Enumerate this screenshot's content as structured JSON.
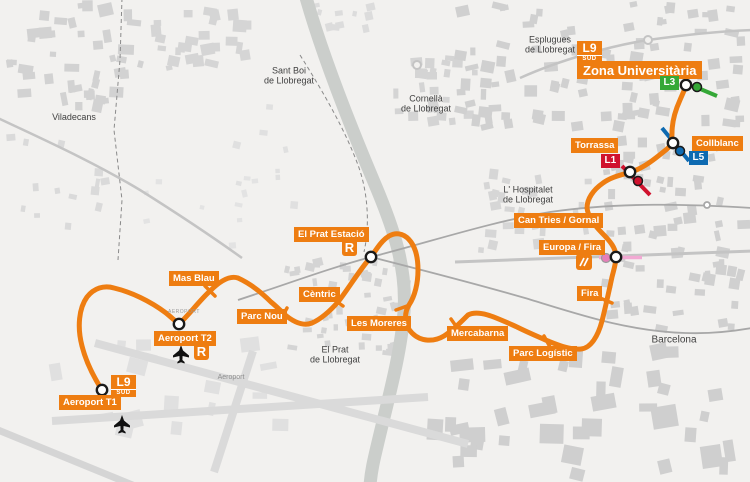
{
  "map_title": "L9 Sud",
  "colors": {
    "l9_orange": "#EE7D11",
    "l1_red": "#D0122E",
    "l3_green": "#35A837",
    "l5_blue": "#0E6AB1",
    "fgc_pink_line": "#F2A9D3",
    "fgc_pink_dot": "#E67FB9",
    "station_ring": "#1a1a1a",
    "plane_black": "#111111"
  },
  "stations": [
    {
      "id": "zona-universitaria",
      "label": "Zona Universitària",
      "x": 577,
      "y": 61,
      "big": true
    },
    {
      "id": "collblanc",
      "label": "Collblanc",
      "x": 692,
      "y": 136
    },
    {
      "id": "torrassa",
      "label": "Torrassa",
      "x": 571,
      "y": 138
    },
    {
      "id": "can-tries-gornal",
      "label": "Can Tries / Gornal",
      "x": 514,
      "y": 213
    },
    {
      "id": "europa-fira",
      "label": "Europa / Fira",
      "x": 539,
      "y": 240
    },
    {
      "id": "fira",
      "label": "Fira",
      "x": 577,
      "y": 286
    },
    {
      "id": "parc-logistic",
      "label": "Parc Logístic",
      "x": 509,
      "y": 346
    },
    {
      "id": "mercabarna",
      "label": "Mercabarna",
      "x": 447,
      "y": 326
    },
    {
      "id": "les-moreres",
      "label": "Les Moreres",
      "x": 347,
      "y": 316
    },
    {
      "id": "el-prat-estacio",
      "label": "El Prat Estació",
      "x": 294,
      "y": 227
    },
    {
      "id": "centric",
      "label": "Cèntric",
      "x": 299,
      "y": 287
    },
    {
      "id": "parc-nou",
      "label": "Parc Nou",
      "x": 237,
      "y": 309
    },
    {
      "id": "mas-blau",
      "label": "Mas Blau",
      "x": 169,
      "y": 271
    },
    {
      "id": "aeroport-t2",
      "label": "Aeroport T2",
      "x": 154,
      "y": 331
    },
    {
      "id": "aeroport-t1",
      "label": "Aeroport T1",
      "x": 59,
      "y": 395
    }
  ],
  "line_badges": [
    {
      "id": "l9-sud-zona",
      "line": "L9",
      "sub": "SUD",
      "x": 577,
      "y": 41
    },
    {
      "id": "l9-sud-t1",
      "line": "L9",
      "sub": "SUD",
      "x": 111,
      "y": 375
    }
  ],
  "connection_badges": [
    {
      "id": "l3",
      "label": "L3",
      "x": 660,
      "y": 76,
      "color_key": "l3_green"
    },
    {
      "id": "l5",
      "label": "L5",
      "x": 689,
      "y": 151,
      "color_key": "l5_blue"
    },
    {
      "id": "l1",
      "label": "L1",
      "x": 601,
      "y": 154,
      "color_key": "l1_red"
    }
  ],
  "rodalies_badges": [
    {
      "id": "r-el-prat",
      "label": "R",
      "x": 342,
      "y": 239
    },
    {
      "id": "r-aeroport-t2",
      "label": "R",
      "x": 194,
      "y": 343
    }
  ],
  "places": [
    {
      "id": "viladecans",
      "label": "Viladecans",
      "x": 74,
      "y": 117,
      "size": 9
    },
    {
      "id": "sant-boi",
      "label": "Sant Boi\nde Llobregat",
      "x": 289,
      "y": 76,
      "size": 9
    },
    {
      "id": "cornella",
      "label": "Cornellà\nde Llobregat",
      "x": 426,
      "y": 104,
      "size": 9
    },
    {
      "id": "esplugues",
      "label": "Esplugues\nde Llobregat",
      "x": 550,
      "y": 45,
      "size": 9
    },
    {
      "id": "hospitalet",
      "label": "L' Hospitalet\nde Llobregat",
      "x": 528,
      "y": 195,
      "size": 9
    },
    {
      "id": "el-prat",
      "label": "El Prat\nde Llobregat",
      "x": 335,
      "y": 355,
      "size": 9
    },
    {
      "id": "barcelona",
      "label": "Barcelona",
      "x": 674,
      "y": 340,
      "size": 10
    },
    {
      "id": "aeroport",
      "label": "Aeroport",
      "x": 231,
      "y": 378,
      "size": 7
    },
    {
      "id": "aeroport-tiny",
      "label": "AEROPORT",
      "x": 184,
      "y": 313,
      "size": 5
    }
  ]
}
